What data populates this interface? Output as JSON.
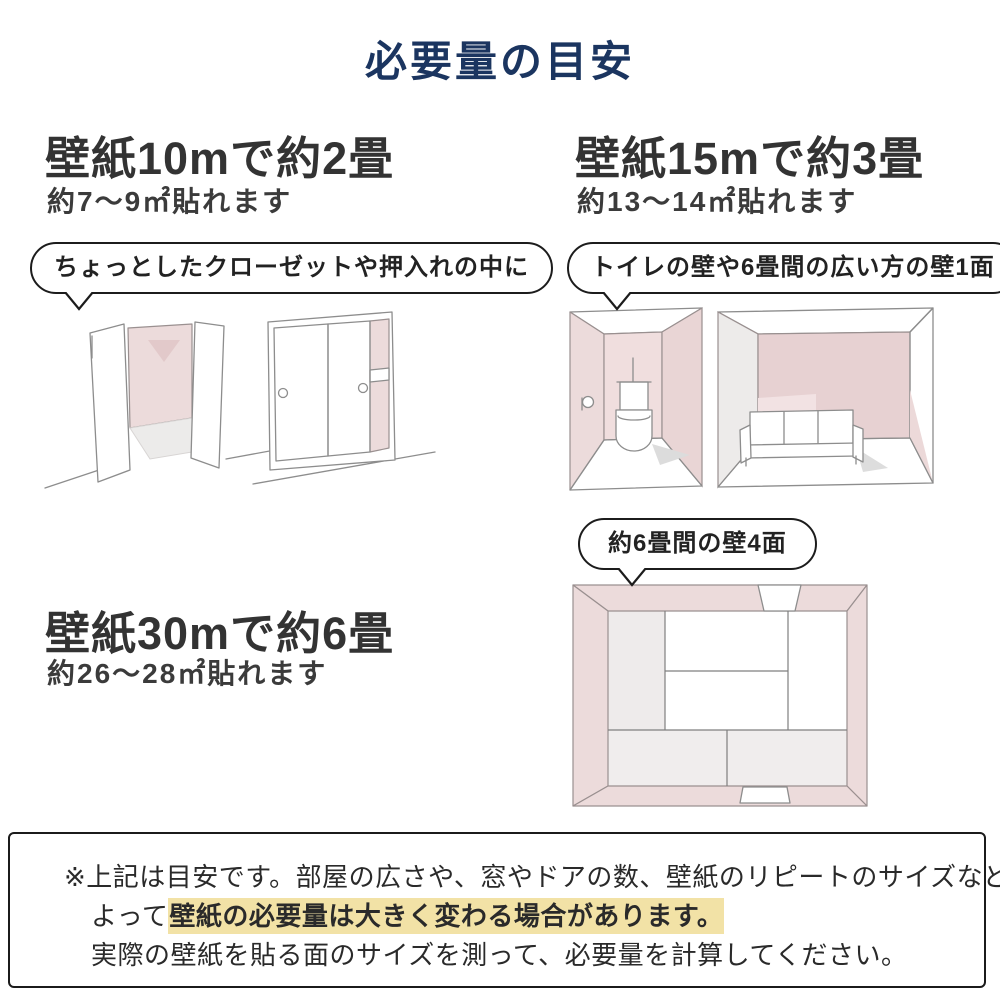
{
  "title": "必要量の目安",
  "colors": {
    "title_navy": "#1b3560",
    "heading_gray": "#333333",
    "wall_pink": "#ecdbdb",
    "highlight_yellow": "#f2e2a6"
  },
  "sections": [
    {
      "heading": "壁紙10mで約2畳",
      "sub": "約7〜9㎡貼れます",
      "bubble": "ちょっとしたクローゼットや押入れの中に",
      "illustrations": [
        "open-closet-sketch",
        "sliding-closet-sketch"
      ]
    },
    {
      "heading": "壁紙15mで約3畳",
      "sub": "約13〜14㎡貼れます",
      "bubble": "トイレの壁や6畳間の広い方の壁1面",
      "illustrations": [
        "toilet-room-sketch",
        "six-mat-room-wall-sketch"
      ]
    },
    {
      "heading": "壁紙30mで約6畳",
      "sub": "約26〜28㎡貼れます",
      "bubble": "約6畳間の壁4面",
      "illustrations": [
        "six-mat-room-top-view-sketch"
      ]
    }
  ],
  "note": {
    "line1": "※上記は目安です。部屋の広さや、窓やドアの数、壁紙のリピートのサイズなどに",
    "line2_prefix": "よって",
    "line2_highlight": "壁紙の必要量は大きく変わる場合があります。",
    "line3": "実際の壁紙を貼る面のサイズを測って、必要量を計算してください。"
  }
}
